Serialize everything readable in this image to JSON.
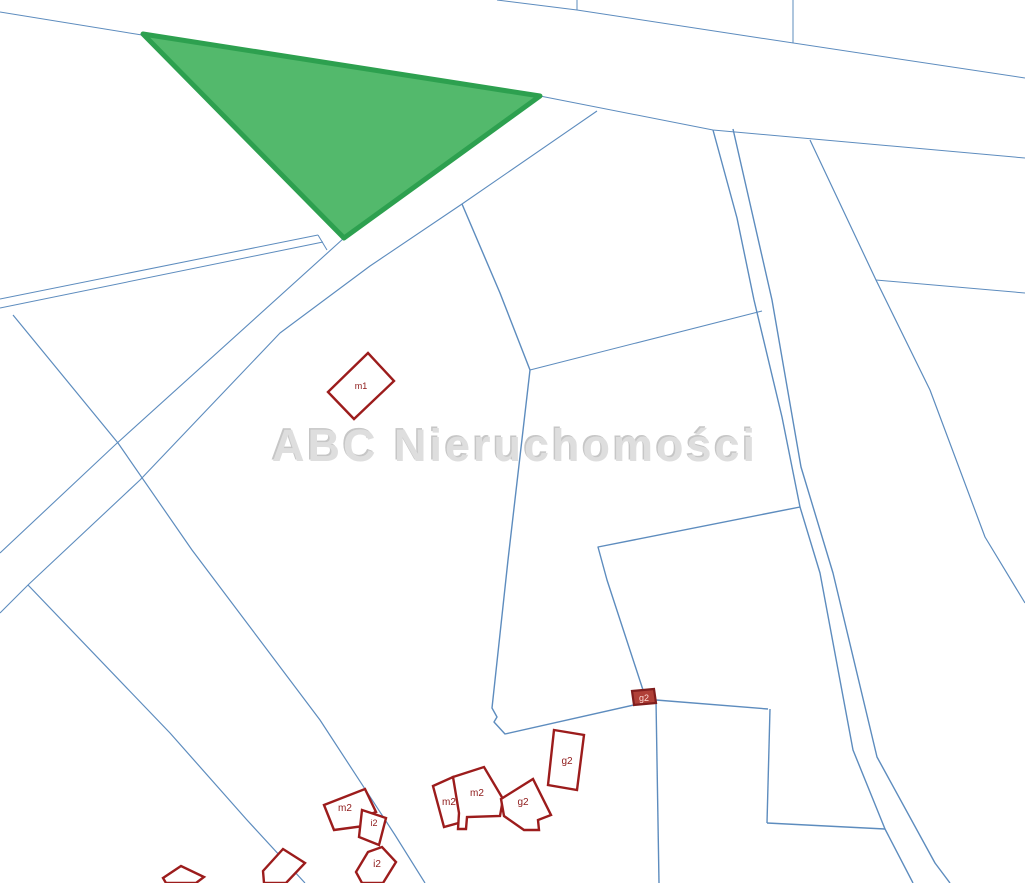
{
  "map": {
    "background": "#ffffff",
    "watermark": {
      "text": "ABC Nieruchomości",
      "x": 515,
      "y": 461,
      "font_size": 45,
      "color": "#dedede",
      "shadow_color": "#c6c6c6"
    },
    "colors": {
      "parcel_line": "#5d8cbe",
      "building_stroke": "#9c1c1c",
      "building_fill": "#ffffff",
      "building_label": "#8e1a1a",
      "highlight_fill": "#53b96c",
      "highlight_stroke": "#2da04f",
      "marker_fill": "#b04038",
      "marker_stroke": "#801d1d",
      "marker_text": "#ffd9d4"
    },
    "highlight_parcel": {
      "name": "highlighted-offer-parcel",
      "points": [
        [
          143,
          34
        ],
        [
          540,
          96
        ],
        [
          344,
          238
        ]
      ],
      "stroke_width": 5
    },
    "parcel_lines": [
      {
        "id": "road-lower-edge",
        "w": 1,
        "points": [
          [
            0,
            12
          ],
          [
            142,
            35
          ],
          [
            540,
            96
          ],
          [
            713,
            130
          ],
          [
            1025,
            158
          ]
        ]
      },
      {
        "id": "road-upper-edge",
        "w": 1,
        "points": [
          [
            497,
            0
          ],
          [
            577,
            10
          ],
          [
            760,
            38
          ],
          [
            1025,
            78
          ]
        ]
      },
      {
        "id": "top-tick-1",
        "w": 1,
        "points": [
          [
            577,
            0
          ],
          [
            577,
            10
          ]
        ]
      },
      {
        "id": "top-tick-2",
        "w": 1,
        "points": [
          [
            793,
            0
          ],
          [
            793,
            43
          ]
        ]
      },
      {
        "id": "band-upper-edge",
        "w": 1.1,
        "points": [
          [
            540,
            96
          ],
          [
            344,
            238
          ],
          [
            115,
            445
          ],
          [
            0,
            553
          ]
        ]
      },
      {
        "id": "band-lower-edge",
        "w": 1.1,
        "points": [
          [
            597,
            111
          ],
          [
            462,
            204
          ],
          [
            370,
            266
          ],
          [
            280,
            333
          ],
          [
            140,
            480
          ],
          [
            28,
            585
          ],
          [
            0,
            613
          ]
        ]
      },
      {
        "id": "lane-edge-a",
        "w": 1,
        "points": [
          [
            0,
            299
          ],
          [
            318,
            235
          ]
        ]
      },
      {
        "id": "lane-edge-b",
        "w": 1,
        "points": [
          [
            0,
            308
          ],
          [
            323,
            242
          ]
        ]
      },
      {
        "id": "lane-end-cap",
        "w": 1,
        "points": [
          [
            318,
            235
          ],
          [
            327,
            250
          ]
        ]
      },
      {
        "id": "west-diagonal",
        "w": 1.2,
        "points": [
          [
            13,
            315
          ],
          [
            118,
            443
          ],
          [
            192,
            550
          ],
          [
            320,
            720
          ],
          [
            395,
            835
          ],
          [
            425,
            883
          ]
        ]
      },
      {
        "id": "southwest-diagonal",
        "w": 1.2,
        "points": [
          [
            28,
            585
          ],
          [
            170,
            733
          ],
          [
            247,
            820
          ],
          [
            305,
            883
          ]
        ]
      },
      {
        "id": "parcel-left-edge",
        "w": 1.4,
        "points": [
          [
            462,
            204
          ],
          [
            500,
            293
          ],
          [
            530,
            370
          ],
          [
            508,
            560
          ],
          [
            492,
            708
          ],
          [
            497,
            717
          ],
          [
            494,
            722
          ],
          [
            505,
            734
          ],
          [
            656,
            700
          ]
        ]
      },
      {
        "id": "parcel-top-edge",
        "w": 1,
        "points": [
          [
            530,
            370
          ],
          [
            762,
            311
          ]
        ]
      },
      {
        "id": "parcel-bottom-edge",
        "w": 1.4,
        "points": [
          [
            800,
            507
          ],
          [
            598,
            547
          ],
          [
            607,
            580
          ],
          [
            643,
            690
          ],
          [
            656,
            700
          ]
        ]
      },
      {
        "id": "junction-south-line",
        "w": 1.4,
        "points": [
          [
            656,
            700
          ],
          [
            659,
            883
          ]
        ]
      },
      {
        "id": "junction-east-line",
        "w": 1.4,
        "points": [
          [
            656,
            700
          ],
          [
            768,
            709
          ]
        ]
      },
      {
        "id": "east-parcel-side",
        "w": 1.4,
        "points": [
          [
            770,
            709
          ],
          [
            767,
            823
          ]
        ]
      },
      {
        "id": "east-parcel-bottom",
        "w": 1.4,
        "points": [
          [
            767,
            823
          ],
          [
            885,
            829
          ]
        ]
      },
      {
        "id": "path-left-edge",
        "w": 1.4,
        "points": [
          [
            713,
            130
          ],
          [
            737,
            218
          ],
          [
            754,
            300
          ],
          [
            782,
            417
          ],
          [
            800,
            507
          ],
          [
            820,
            573
          ],
          [
            853,
            750
          ],
          [
            885,
            829
          ],
          [
            913,
            883
          ]
        ]
      },
      {
        "id": "path-right-edge",
        "w": 1.4,
        "points": [
          [
            733,
            129
          ],
          [
            772,
            300
          ],
          [
            801,
            467
          ],
          [
            833,
            573
          ],
          [
            877,
            757
          ],
          [
            935,
            863
          ],
          [
            950,
            883
          ]
        ]
      },
      {
        "id": "right-diagonal",
        "w": 1.2,
        "points": [
          [
            810,
            140
          ],
          [
            876,
            280
          ],
          [
            930,
            390
          ],
          [
            985,
            537
          ],
          [
            1025,
            603
          ]
        ]
      },
      {
        "id": "right-horizontal",
        "w": 1,
        "points": [
          [
            876,
            280
          ],
          [
            1025,
            293
          ]
        ]
      }
    ],
    "buildings": [
      {
        "label": "m1",
        "label_x": 361,
        "label_y": 389,
        "font": 9,
        "points": [
          [
            328,
            392
          ],
          [
            368,
            353
          ],
          [
            394,
            381
          ],
          [
            354,
            419
          ]
        ]
      },
      {
        "label": "m2",
        "label_x": 345,
        "label_y": 811,
        "font": 10,
        "points": [
          [
            324,
            805
          ],
          [
            365,
            789
          ],
          [
            376,
            812
          ],
          [
            362,
            817
          ],
          [
            364,
            826
          ],
          [
            334,
            830
          ]
        ]
      },
      {
        "label": "i2",
        "label_x": 374,
        "label_y": 826,
        "font": 9,
        "points": [
          [
            362,
            810
          ],
          [
            386,
            818
          ],
          [
            379,
            845
          ],
          [
            359,
            837
          ]
        ]
      },
      {
        "label": "i2",
        "label_x": 377,
        "label_y": 867,
        "font": 10,
        "points": [
          [
            356,
            872
          ],
          [
            368,
            852
          ],
          [
            382,
            847
          ],
          [
            396,
            862
          ],
          [
            383,
            883
          ],
          [
            362,
            883
          ]
        ]
      },
      {
        "label": "m2",
        "label_x": 449,
        "label_y": 805,
        "font": 10,
        "points": [
          [
            433,
            786
          ],
          [
            453,
            777
          ],
          [
            464,
            813
          ],
          [
            460,
            814
          ],
          [
            462,
            822
          ],
          [
            444,
            827
          ]
        ]
      },
      {
        "label": "m2",
        "label_x": 477,
        "label_y": 796,
        "font": 10,
        "points": [
          [
            453,
            777
          ],
          [
            484,
            767
          ],
          [
            503,
            799
          ],
          [
            500,
            816
          ],
          [
            467,
            817
          ],
          [
            466,
            829
          ],
          [
            458,
            829
          ],
          [
            459,
            813
          ]
        ]
      },
      {
        "label": "g2",
        "label_x": 523,
        "label_y": 805,
        "font": 10,
        "points": [
          [
            501,
            799
          ],
          [
            533,
            779
          ],
          [
            551,
            815
          ],
          [
            538,
            820
          ],
          [
            539,
            830
          ],
          [
            524,
            830
          ],
          [
            504,
            816
          ]
        ]
      },
      {
        "label": "g2",
        "label_x": 567,
        "label_y": 764,
        "font": 10,
        "points": [
          [
            554,
            730
          ],
          [
            584,
            735
          ],
          [
            577,
            790
          ],
          [
            548,
            785
          ]
        ]
      },
      {
        "label": "",
        "label_x": 0,
        "label_y": 0,
        "font": 0,
        "points": [
          [
            263,
            871
          ],
          [
            283,
            849
          ],
          [
            305,
            863
          ],
          [
            286,
            883
          ],
          [
            264,
            883
          ]
        ]
      },
      {
        "label": "",
        "label_x": 0,
        "label_y": 0,
        "font": 0,
        "points": [
          [
            163,
            878
          ],
          [
            181,
            866
          ],
          [
            204,
            877
          ],
          [
            196,
            883
          ],
          [
            166,
            883
          ]
        ]
      }
    ],
    "marker": {
      "label": "g2",
      "label_x": 644,
      "label_y": 701,
      "font": 9,
      "points": [
        [
          632,
          691
        ],
        [
          654,
          689
        ],
        [
          656,
          703
        ],
        [
          634,
          705
        ]
      ]
    }
  }
}
